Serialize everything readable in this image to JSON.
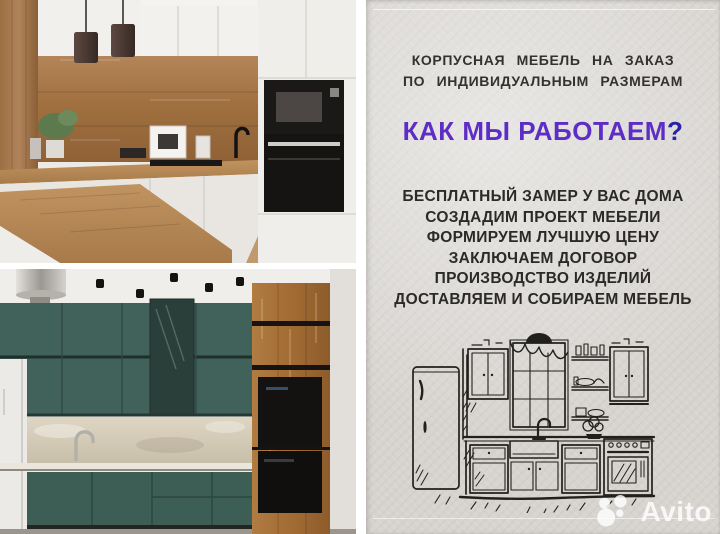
{
  "panel": {
    "tagline_line1": "КОРПУСНАЯ МЕБЕЛЬ НА ЗАКАЗ",
    "tagline_line2": "ПО ИНДИВИДУАЛЬНЫМ РАЗМЕРАМ",
    "heading": "КАК МЫ РАБОТАЕМ",
    "heading_question_mark": "?",
    "steps": [
      "БЕСПЛАТНЫЙ ЗАМЕР У ВАС ДОМА",
      "СОЗДАДИМ ПРОЕКТ МЕБЕЛИ",
      "ФОРМИРУЕМ ЛУЧШУЮ ЦЕНУ",
      "ЗАКЛЮЧАЕМ ДОГОВОР",
      "ПРОИЗВОДСТВО ИЗДЕЛИЙ",
      "ДОСТАВЛЯЕМ И СОБИРАЕМ МЕБЕЛЬ"
    ],
    "illustration": "kitchen-line-sketch"
  },
  "photos": {
    "top": "white and wood kitchen with black built-in ovens and two dark pendant lamps",
    "bottom": "teal green kitchen with wood tall column and black built-in ovens"
  },
  "watermark": {
    "label": "Avito"
  },
  "colors": {
    "panel_bg": "#d7d4d0",
    "text_dark": "#2b2a27",
    "heading_purple": "#5e2dc5",
    "question_navy": "#2a21a6",
    "sketch_ink": "#21201d",
    "teal_cabinet": "#41625a",
    "wood": "#a9774a",
    "watermark_white": "rgba(255,255,255,0.82)"
  }
}
